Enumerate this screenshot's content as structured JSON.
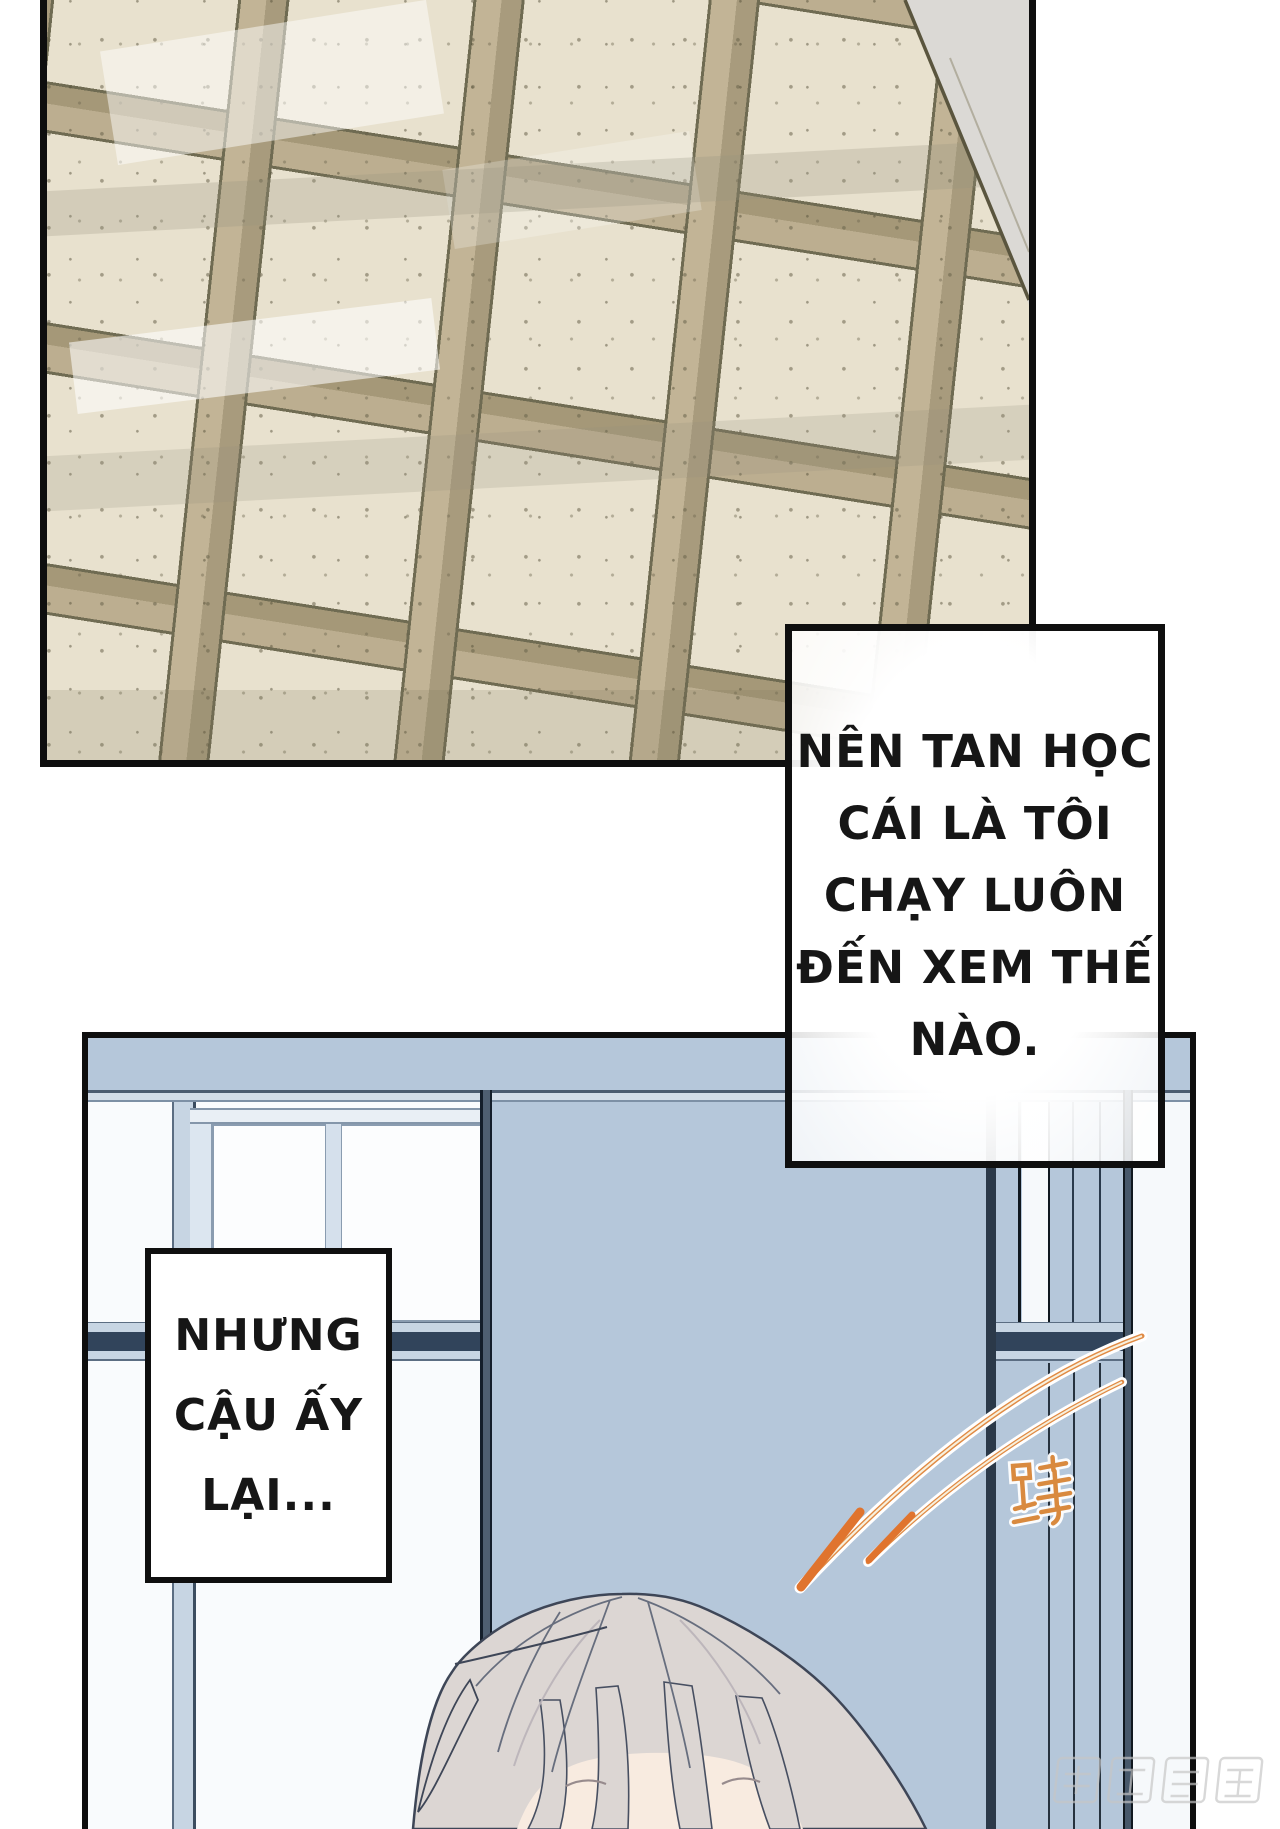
{
  "page": {
    "width": 1280,
    "height": 1829,
    "background": "#ffffff",
    "type": "comic-page"
  },
  "panels": {
    "floor": {
      "description": "speckled beige floor tiles seen in perspective with tan border bands and gray wall wedge"
    },
    "window": {
      "description": "classroom sliding window, light blue glass, white frames, open sash letting white light in"
    }
  },
  "bubbles": {
    "narration_1": {
      "lines": [
        "NÊN TAN HỌC",
        "CÁI LÀ TÔI",
        "CHẠY LUÔN",
        "ĐẾN XEM THẾ",
        "NÀO."
      ]
    },
    "narration_2": {
      "lines": [
        "NHƯNG",
        "CẬU ẤY",
        "LẠI..."
      ]
    }
  },
  "sfx": {
    "char": "蹲",
    "style": "hand-drawn orange hanzi with white halo beside two orange motion swoosh lines"
  },
  "watermark": {
    "text": "腾讯动漫"
  },
  "character": {
    "description": "top of a head with pale warm-gray hair and closed eyes entering from bottom edge"
  },
  "colors": {
    "tile_cream": "#e8e1ce",
    "tile_band": "#c2b496",
    "tile_grout": "#6f6b52",
    "wall_gray": "#dbd9d5",
    "window_blue": "#b5c7da",
    "frame_white": "#f6f9fb",
    "frame_navy": "#31445b",
    "frame_slate": "#47586a",
    "swoosh_orange": "#e08a44",
    "swoosh_core": "#f8f0dc",
    "sfx_orange": "#d98a3f",
    "hair": "#dcd6d3",
    "hair_line": "#3e4657",
    "skin": "#f8ebe0",
    "watermark_gray": "#c6c6c6"
  }
}
